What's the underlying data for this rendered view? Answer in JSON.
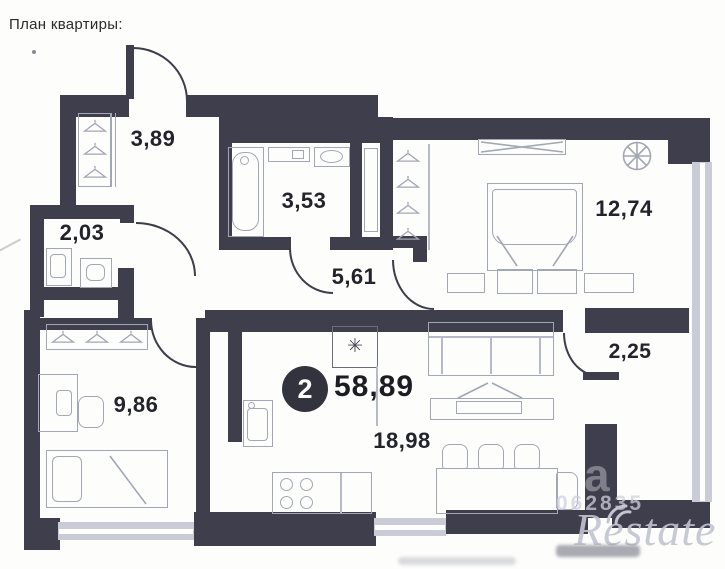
{
  "title": "План квартиры:",
  "rooms": {
    "entry": "3,89",
    "toilet": "2,03",
    "bathroom": "3,53",
    "hallway": "5,61",
    "bedroom": "12,74",
    "bedroom2": "9,86",
    "balcony": "2,25",
    "kitchen_living": "18,98"
  },
  "summary": {
    "rooms_count": "2",
    "total_area": "58,89"
  },
  "symbols": {
    "boiler": "✳"
  },
  "watermark": {
    "letter": "a",
    "code": "062835",
    "brand": "Restate"
  },
  "colors": {
    "wall": "#3e3e4c",
    "wallline": "#3c3c4a",
    "window": "#c9cbd6",
    "furn": "#a2a7b6",
    "furnlight": "#b6bac6",
    "label": "#23232b",
    "badge": "#33333e",
    "paper": "#fdfdfb"
  }
}
